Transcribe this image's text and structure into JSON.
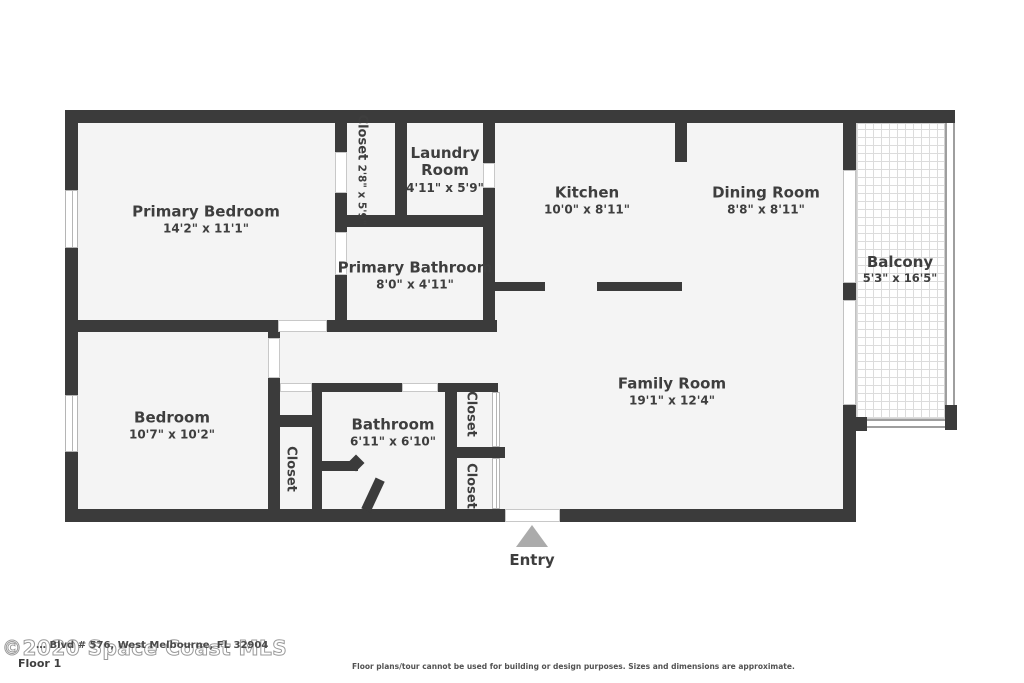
{
  "rooms": {
    "primary_bedroom": {
      "name": "Primary Bedroom",
      "dims": "14'2\" x 11'1\""
    },
    "closet_top": {
      "name": "Closet",
      "dims": "2'8\" x 5'9\""
    },
    "laundry": {
      "name": "Laundry Room",
      "dims": "4'11\" x 5'9\""
    },
    "kitchen": {
      "name": "Kitchen",
      "dims": "10'0\" x 8'11\""
    },
    "dining": {
      "name": "Dining Room",
      "dims": "8'8\" x 8'11\""
    },
    "balcony": {
      "name": "Balcony",
      "dims": "5'3\" x 16'5\""
    },
    "primary_bathroom": {
      "name": "Primary Bathroom",
      "dims": "8'0\" x 4'11\""
    },
    "bedroom": {
      "name": "Bedroom",
      "dims": "10'7\" x 10'2\""
    },
    "bathroom": {
      "name": "Bathroom",
      "dims": "6'11\" x 6'10\""
    },
    "family_room": {
      "name": "Family Room",
      "dims": "19'1\" x 12'4\""
    },
    "closet_hall": {
      "name": "Closet"
    },
    "closet_right_top": {
      "name": "Closet"
    },
    "closet_right_bottom": {
      "name": "Closet"
    }
  },
  "entry": {
    "label": "Entry"
  },
  "footer": {
    "watermark": "©2020 Space Coast MLS",
    "floor_label": "Floor 1",
    "address": "… Blvd # 576, West Melbourne, FL 32904",
    "disclaimer": "Floor plans/tour cannot be used for building or design purposes. Sizes and dimensions are approximate."
  },
  "colors": {
    "wall": "#3b3b3b",
    "room_fill": "#f4f4f4",
    "label_text": "#3e3e3e",
    "entry_arrow": "#ababab",
    "railing": "#9e9e9e",
    "watermark_outline": "#9a9a9a"
  }
}
